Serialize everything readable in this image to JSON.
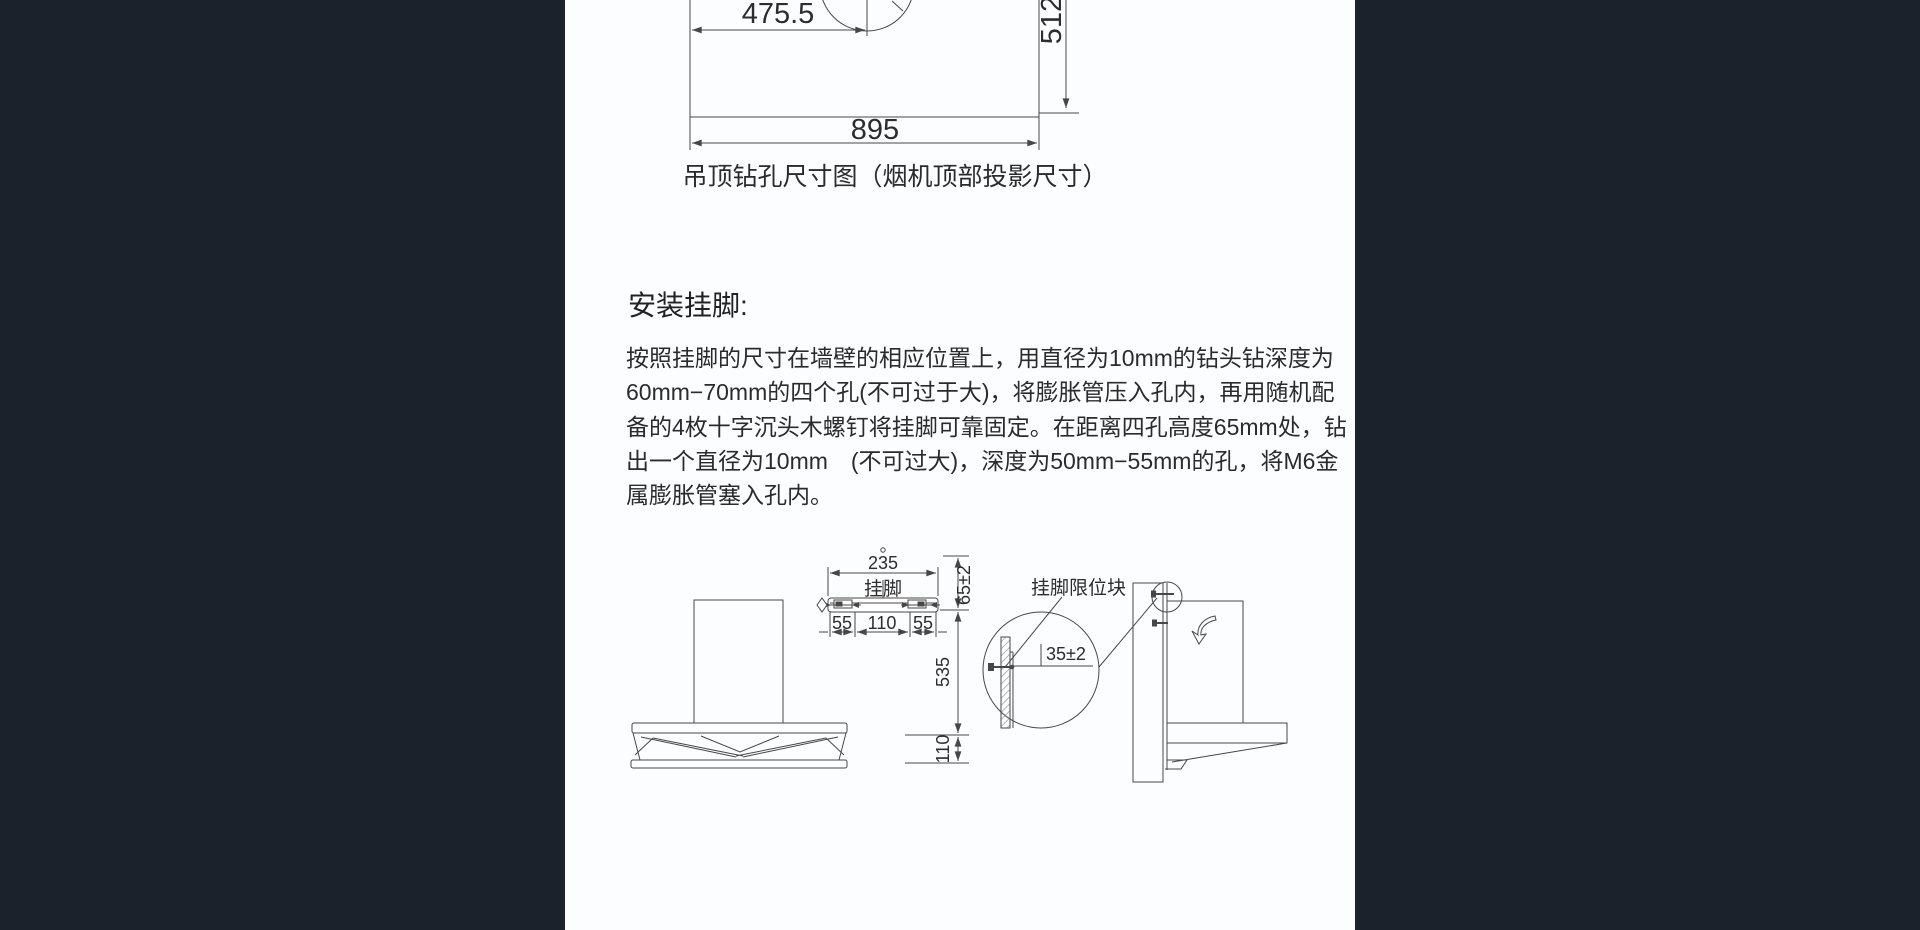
{
  "page": {
    "background": "#1a222c",
    "panel_color": "#fcfdff",
    "line_color": "#474747"
  },
  "top_figure": {
    "hole_offset": "475.5",
    "depth": "512",
    "width": "895",
    "caption": "吊顶钻孔尺寸图（烟机顶部投影尺寸）"
  },
  "install_section": {
    "heading": "安装挂脚:",
    "lines": [
      "按照挂脚的尺寸在墙壁的相应位置上，用直径为10mm的钻头钻深度为",
      "60mm−70mm的四个孔(不可过于大)，将膨胀管压入孔内，再用随机配",
      "备的4枚十字沉头木螺钉将挂脚可靠固定。在距离四孔高度65mm处，钻",
      "出一个直径为10mm　(不可过大)，深度为50mm−55mm的孔，将M6金",
      "属膨胀管塞入孔内。"
    ]
  },
  "bottom_figure": {
    "bracket": {
      "width": "235",
      "label": "挂脚",
      "seg_left": "55",
      "seg_mid": "110",
      "seg_right": "55"
    },
    "chain": {
      "offset": "65±2",
      "upper": "535",
      "lower": "110"
    },
    "detail": {
      "label": "挂脚限位块",
      "gap": "35±2"
    }
  }
}
